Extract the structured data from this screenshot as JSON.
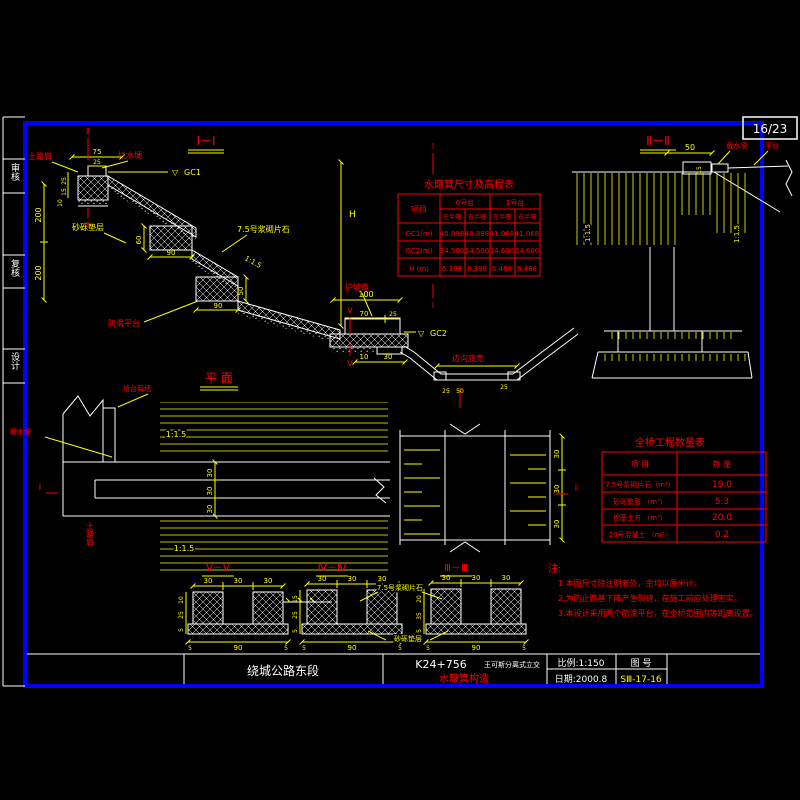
{
  "sheet": {
    "no": "16/23"
  },
  "sidebar": {
    "review": "审核",
    "check": "复核",
    "design": "设计"
  },
  "common": {
    "d30": "30",
    "d90": "90",
    "d5": "5",
    "slope": "1:1.5",
    "tri": "▽"
  },
  "i1": {
    "title": "Ⅰ－Ⅰ",
    "red": {
      "shoulder": "土路肩",
      "ridge": "拦水埂",
      "berm": "护坡道",
      "ditch_width": "边沟底宽",
      "platform": "防滑平台",
      "mark2": "Ⅱ",
      "mark1": "Ⅰ",
      "mark5": "Ⅴ"
    },
    "yel": {
      "cushion": "砂砾垫层",
      "masonry": "7.5号浆砌片石",
      "gc1": "GC1",
      "gc2": "GC2",
      "h": "H"
    },
    "d": {
      "w75": "75",
      "w25": "25",
      "v25": "25",
      "v15": "15",
      "v10": "10",
      "v200a": "200",
      "v200b": "200",
      "s60": "60",
      "s90": "90",
      "t50": "50",
      "t90": "90",
      "a100": "100",
      "a70": "70",
      "a25": "25",
      "b10": "10",
      "b30": "30",
      "k25a": "25",
      "k50": "50",
      "k25b": "25"
    }
  },
  "i2": {
    "title": "Ⅱ－Ⅱ",
    "red": {
      "ridge": "截水埂",
      "platform": "平台"
    },
    "d": {
      "w50": "50",
      "v15": "15"
    }
  },
  "plan": {
    "title": "平 面",
    "red": {
      "earwall": "桥台耳墙",
      "ridge": "截水埂",
      "shoulder": "土路肩",
      "mark1": "Ⅰ"
    }
  },
  "elev_table": {
    "title": "水簸箕尺寸及高程表",
    "item_col": "项目",
    "g0": "0号台",
    "g3": "3号台",
    "sub_l": "左半幅",
    "sub_r": "右半幅",
    "rows": [
      {
        "n": "GC1(m)",
        "v": [
          "40.898",
          "40.898",
          "41.068",
          "41.068"
        ]
      },
      {
        "n": "GC2(m)",
        "v": [
          "34.500",
          "34.500",
          "34.600",
          "34.600"
        ]
      },
      {
        "n": "H (m)",
        "v": [
          "6.398",
          "6.398",
          "6.468",
          "6.468"
        ]
      }
    ]
  },
  "qty_table": {
    "title": "全桥工程数量表",
    "h_item": "项    目",
    "h_qty": "数    量",
    "rows": [
      {
        "n": "7.5号浆砌片石（m³）",
        "q": "19.0"
      },
      {
        "n": "砂砾垫层 （m³）",
        "q": "5.3"
      },
      {
        "n": "挖基土方 （m³）",
        "q": "20.0"
      },
      {
        "n": "20号混凝土 （m³）",
        "q": "0.2"
      }
    ]
  },
  "sections": {
    "s5": {
      "title": "Ⅴ－Ⅴ",
      "l1": "10",
      "l2": "25",
      "l3": "5"
    },
    "s4": {
      "title": "Ⅳ－Ⅳ",
      "l1": "15",
      "l2": "25",
      "l3": "5"
    },
    "s3": {
      "title": "Ⅲ－Ⅲ",
      "l1": "20",
      "l2": "35",
      "l3": "5"
    },
    "masonry": "7.5号浆砌片石",
    "cushion": "砂砾垫层"
  },
  "notes": {
    "head": "注:",
    "n1": "1.本图尺寸除注明者外，余均以厘米计。",
    "n2": "2.为防止路基下降产生裂缝，在施工前应处理密实。",
    "n3": "3.本设计采用两个防滑平台，在全桥范围内等距离设置。"
  },
  "titleblock": {
    "project": "绕城公路东段",
    "station": "K24+756",
    "interchange": "王可斯分离式立交",
    "drawing": "水簸箕构造",
    "scale": "比例:1:150",
    "date": "日期:2000.8",
    "fig_label": "图  号",
    "fig_no": "SⅢ-17-16"
  }
}
